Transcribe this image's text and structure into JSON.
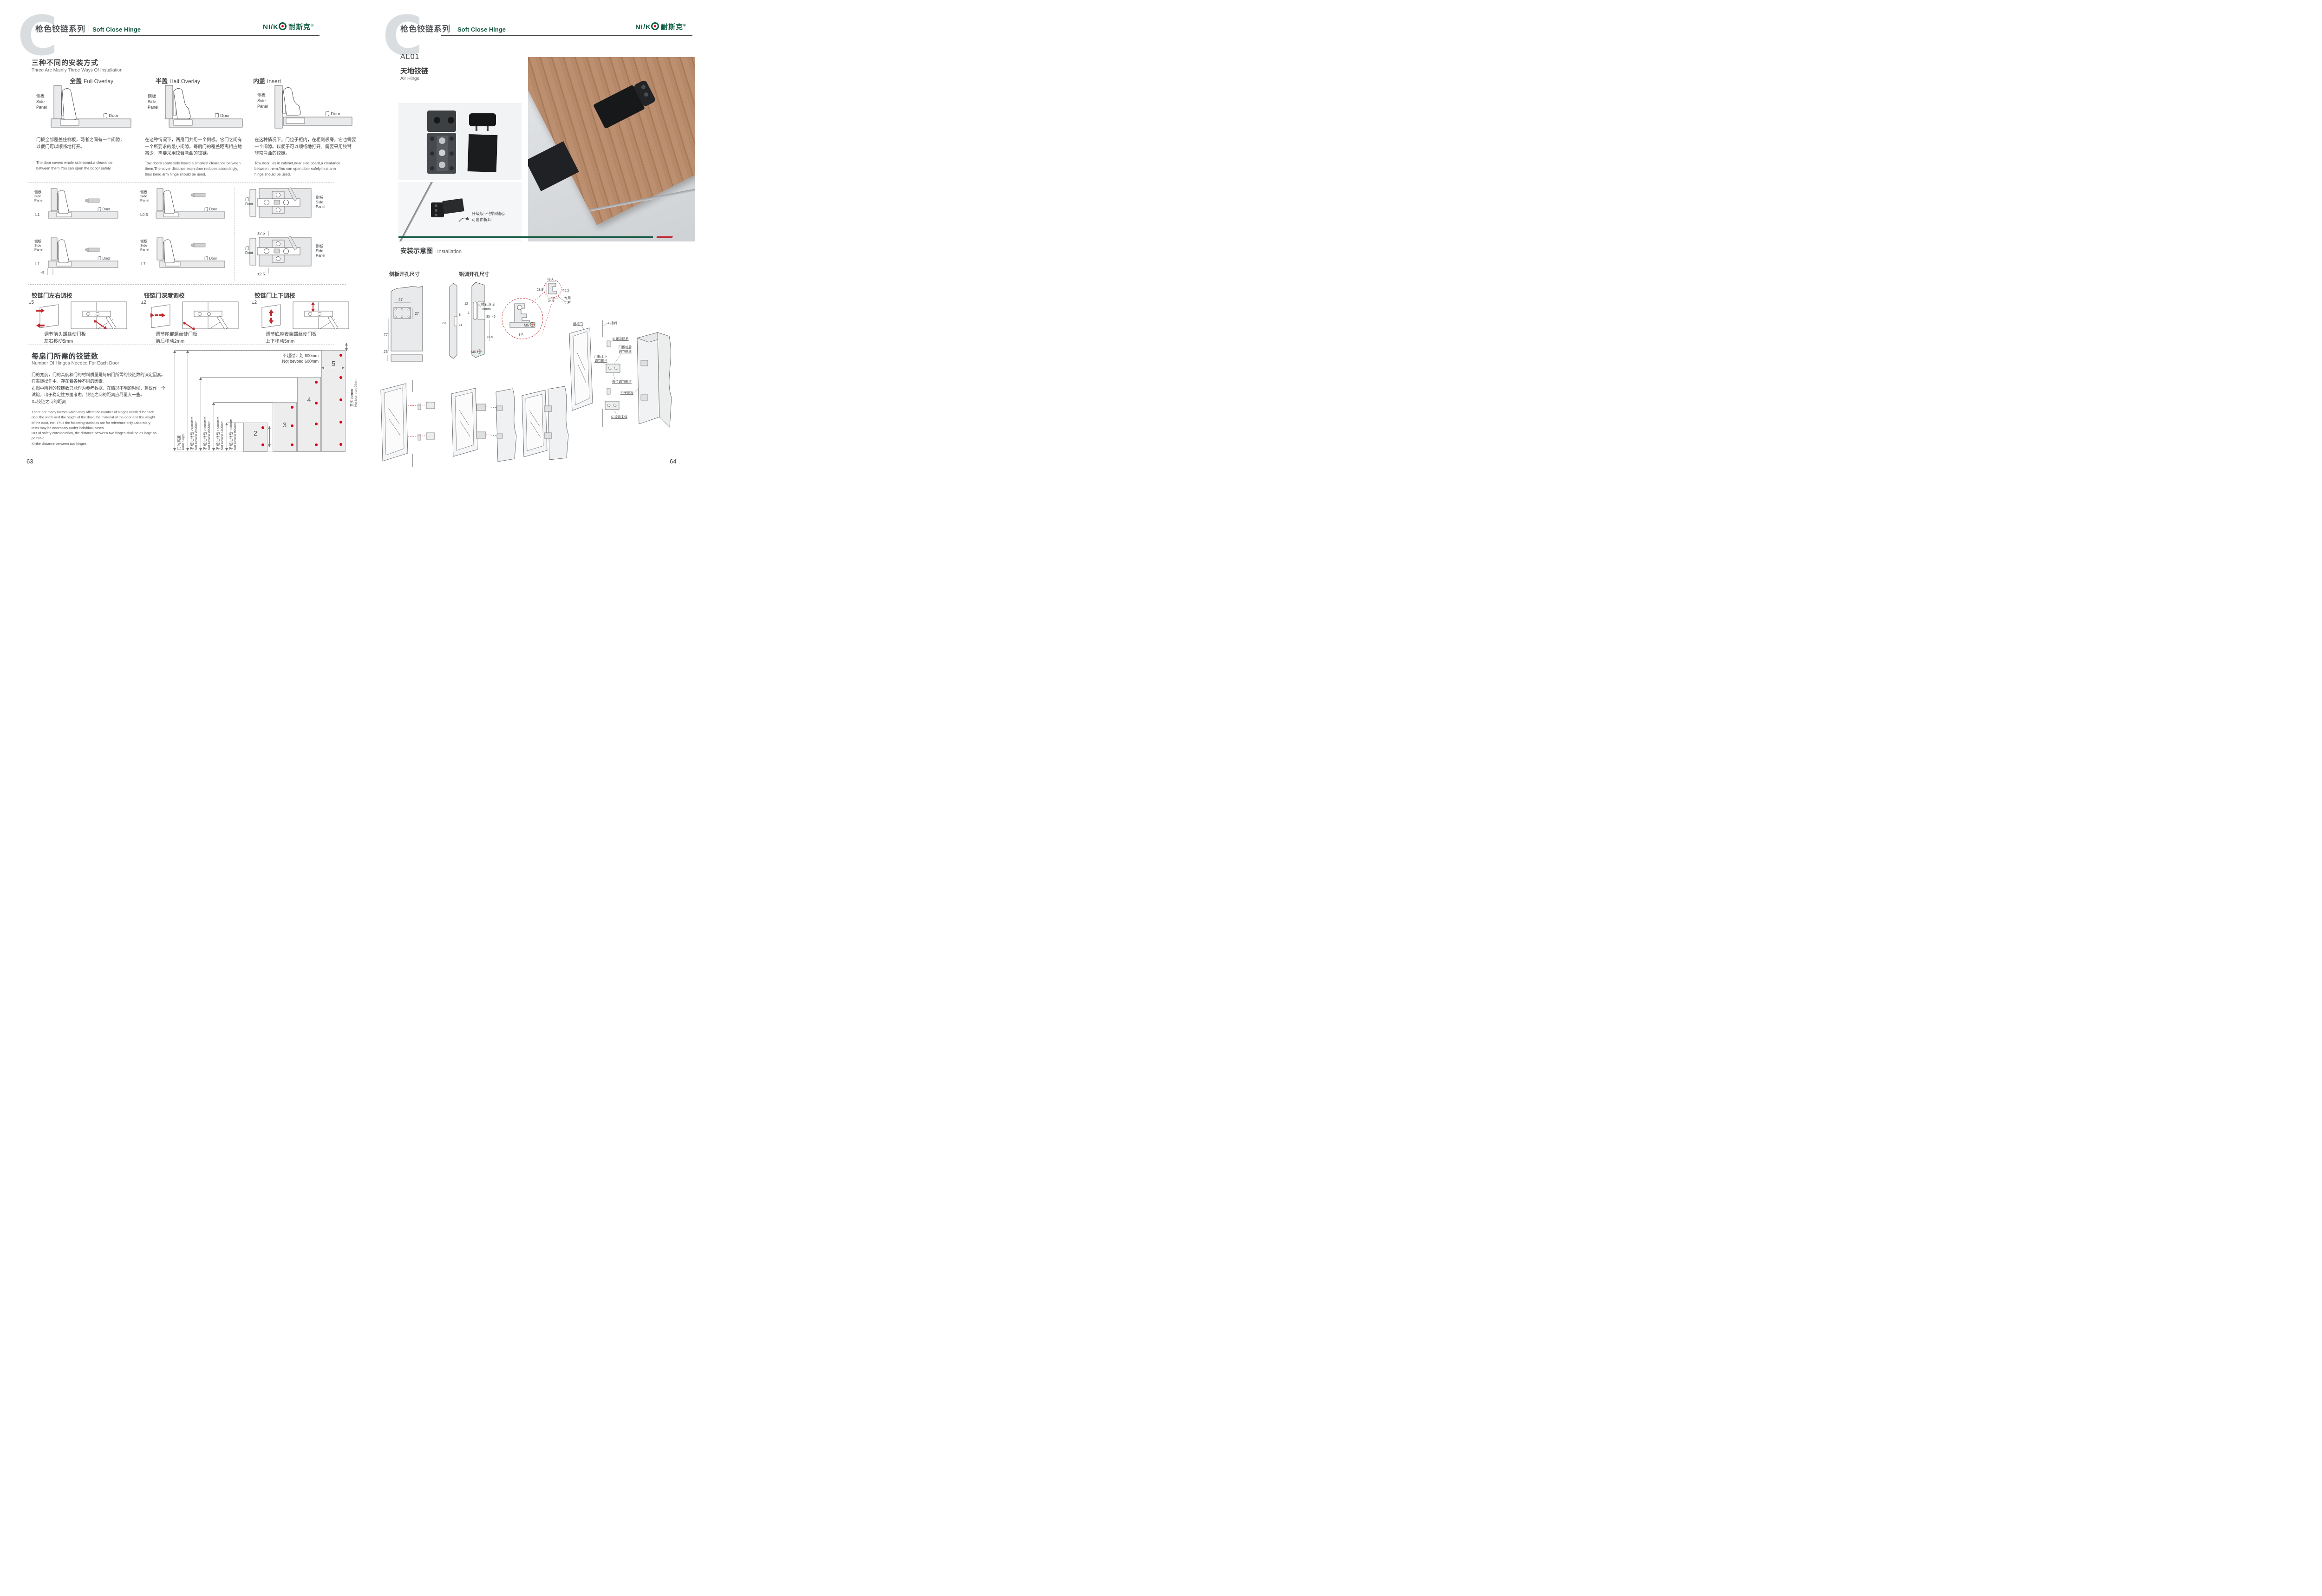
{
  "header": {
    "watermark": "C",
    "series_cn": "枪色铰链系列",
    "series_en": "Soft Close Hinge",
    "logo_latin": "NI/K",
    "logo_cn": "耐斯克",
    "logo_reg": "®"
  },
  "labels": {
    "side_cn": "侧板",
    "side_en1": "Side",
    "side_en2": "Panel",
    "door": "门 Door",
    "door_cn": "门",
    "door_en": "Door"
  },
  "left": {
    "install": {
      "title_cn": "三种不同的安装方式",
      "title_en": "Three Are Mainly Three Ways Of Installation",
      "col1": {
        "name_cn": "全盖",
        "name_en": "Full Overlay",
        "desc_cn1": "门板全部覆盖住侧板，两者之间有一个间隙，",
        "desc_cn2": "以便门可以顺畅地打开。",
        "desc_en1": "The door covers whole side board,a clearance",
        "desc_en2": "between them,You can open the bdoor safely."
      },
      "col2": {
        "name_cn": "半盖",
        "name_en": "Half Overlay",
        "desc_cn1": "在这种情况下，两扇门共用一个侧板。它们之间有",
        "desc_cn2": "一个所要求的最小间隙。每扇门的覆盖距离相应地",
        "desc_cn3": "减少，需要采用铰臂弯曲的铰链。",
        "desc_en1": "Tow doors share side board,a smallest clearance between",
        "desc_en2": "them,The cover distance each door reduces accordingly,",
        "desc_en3": "thus bend arm hinge should be used."
      },
      "col3": {
        "name_cn": "内盖",
        "name_en": "Insert",
        "desc_cn1": "在这种情况下，门位于柜内，在柜侧板旁。它也需要",
        "desc_cn2": "一个间隙。以便于可以顺畅地打开。需要采用铰臂",
        "desc_cn3": "非常弯曲的铰链。",
        "desc_en1": "Tow door lies in cabinet,near side board,a clearance",
        "desc_en2": "between them.You can open door safely,thus arm",
        "desc_en3": "hinge should be used."
      }
    },
    "overlay": {
      "dim1": "L1",
      "dim2": "L0.5",
      "dim3": "L1",
      "dim3b": "+5",
      "dim4": "L7",
      "plate_dim_top": "±2.5",
      "plate_dim_bottom": "±2.5"
    },
    "adjust": {
      "a1": {
        "title": "铰链门左右调校",
        "range": "±5",
        "cap1": "调节前头螺丝使门板",
        "cap2": "左右移动5mm"
      },
      "a2": {
        "title": "铰链门深度调校",
        "range": "±2",
        "cap1": "调节尾部螺丝使门板",
        "cap2": "前后移动2mm"
      },
      "a3": {
        "title": "铰链门上下调校",
        "range": "±2",
        "cap1": "调节底座安装螺丝使门板",
        "cap2": "上下移动5mm"
      }
    },
    "hinges_needed": {
      "title_cn": "每扇门所需的铰链数",
      "title_en": "Number Of Hinges Needed For Each Door",
      "cn1": "门的宽度，门的高度和门的材料质量是每扇门所需的铰链数的决定因素。",
      "cn2": "在实际操作中，存在着各种不同的因素。",
      "cn3": "右图中所列的铰链数只能作为参考数据，在情况不明的时候，建议作一个",
      "cn4": "试验，出于稳定性方面考虑，铰链之间的距离应尽量大一些。",
      "cn5": "X=铰链之间的距离",
      "en1": "There are many factors which may affect the number of hinges needed for each",
      "en2": "door.the width and the height of the door, the material of the door and the weight",
      "en3": "of the door, etc, Thus the following statistics are for reference only.Laboratory",
      "en4": "tests may be necessary under individual cases.",
      "en5": "Out of safety consideration, the distance between two hinges shall be as large as",
      "en6": "possible.",
      "en7": "X=the distance between two hinges"
    },
    "page_no": "63"
  },
  "chart_data": {
    "type": "bar",
    "title_cn": "每扇门所需的铰链数",
    "title_en": "Number Of Hinges Needed For Each Door",
    "ylabel_cn": "门的高度",
    "ylabel_en": "Door height",
    "categories": [
      "2",
      "3",
      "4",
      "5"
    ],
    "values": [
      2,
      3,
      4,
      5
    ],
    "bar_heights_mm": [
      900,
      1600,
      2000,
      2400
    ],
    "height_limits": [
      {
        "cn": "不超过计划2400mm",
        "en": "Not bevond 2400mm",
        "mm": 2400
      },
      {
        "cn": "不超过计划2000mm",
        "en": "Not bevond 2000mm",
        "mm": 2000
      },
      {
        "cn": "不超过计划1600mm",
        "en": "Not bevond 1600mm",
        "mm": 1600
      },
      {
        "cn": "不超过计划900mm",
        "en": "Not bevond 900mm",
        "mm": 900
      }
    ],
    "width_limit_cn": "不超过计划 600mm",
    "width_limit_en": "Not bevond 600mm",
    "edge_min_cn": "至少90mm",
    "edge_min_en": "Not less than 90mm",
    "legend_note": "red dots = hinge positions",
    "dot_color": "#d7000f",
    "bar_fill": "#ededee"
  },
  "right": {
    "product": {
      "code": "AL01",
      "name_cn": "天地铰链",
      "name_en": "Air Hinge"
    },
    "photo_note1": "升级版·不锈钢轴心",
    "photo_note2": "可自由拆卸",
    "install_title_cn": "安装示意图",
    "install_title_en": "Installation",
    "side_hole_title": "侧板开孔尺寸",
    "alu_hole_title": "铝调开孔尺寸",
    "slot1": "槽孔深度",
    "slot2": "18mm",
    "dims": {
      "d47": "47",
      "d27": "27",
      "d77": "77",
      "d25": "25",
      "d8": "8",
      "d20": "20",
      "d11": "11",
      "d12": "12",
      "d1": "1",
      "d33": "33",
      "d46": "46",
      "d155": "15.5",
      "m5a": "M5",
      "m5b": "M5"
    },
    "profile": {
      "w_top": "14.1",
      "h_left": "28.9",
      "dia": "Φ6.2",
      "w_bot": "34.9",
      "mat1": "专用",
      "mat2": "铝材",
      "scale": "1:5"
    },
    "exploded": {
      "alu_door": "铝框门",
      "pin": "A 插销",
      "damper": "B 缓冲阻尼",
      "fb1": "门板前后",
      "fb2": "调节螺丝",
      "ud1": "门板上下",
      "ud2": "调节螺丝",
      "cover": "盖位调节螺丝",
      "side": "柜子侧板",
      "hinge": "C 铰链主体"
    },
    "page_no": "64"
  }
}
